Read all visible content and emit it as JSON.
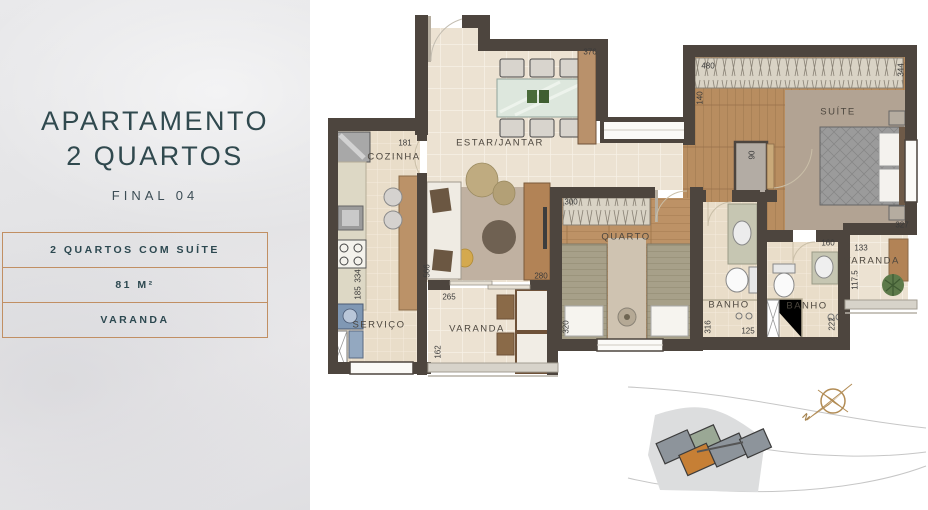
{
  "sidebar": {
    "title_line1": "APARTAMENTO",
    "title_line2": "2 QUARTOS",
    "final_label": "FINAL 04",
    "features": [
      {
        "label": "2 QUARTOS COM SUÍTE"
      },
      {
        "label": "81 M²"
      },
      {
        "label": "VARANDA"
      }
    ]
  },
  "plan": {
    "rooms": {
      "estar_jantar": "ESTAR/JANTAR",
      "cozinha": "COZINHA",
      "servico": "SERVIÇO",
      "varanda_social": "VARANDA",
      "quarto": "QUARTO",
      "banho_social": "BANHO",
      "banho_suite": "BANHO",
      "suite": "SUÍTE",
      "varanda_suite": "VARANDA"
    },
    "dimensions": {
      "estar_width": "376",
      "cozinha_width": "181",
      "suite_width": "480",
      "suite_depth": "344",
      "suite_entry": "140",
      "hall_width": "90",
      "quarto_width": "300",
      "suite_side": "327",
      "banho_suite_width": "160",
      "varanda_suite_width": "133",
      "varanda_suite_depth": "117.5",
      "estar_door": "280",
      "varanda_width": "265",
      "estar_depth": "566",
      "varanda_depth": "162",
      "cozinha_depth": "334",
      "servico_width": "185",
      "quarto_depth": "320",
      "banho_depth": "316",
      "banho_width": "125",
      "banho_suite_depth": "222"
    }
  },
  "site_map": {
    "compass_label": "N"
  },
  "colors": {
    "wall": "#4d453e",
    "accent_border": "#c18f63",
    "title": "#30494e",
    "highlight_unit": "#c67f35"
  }
}
